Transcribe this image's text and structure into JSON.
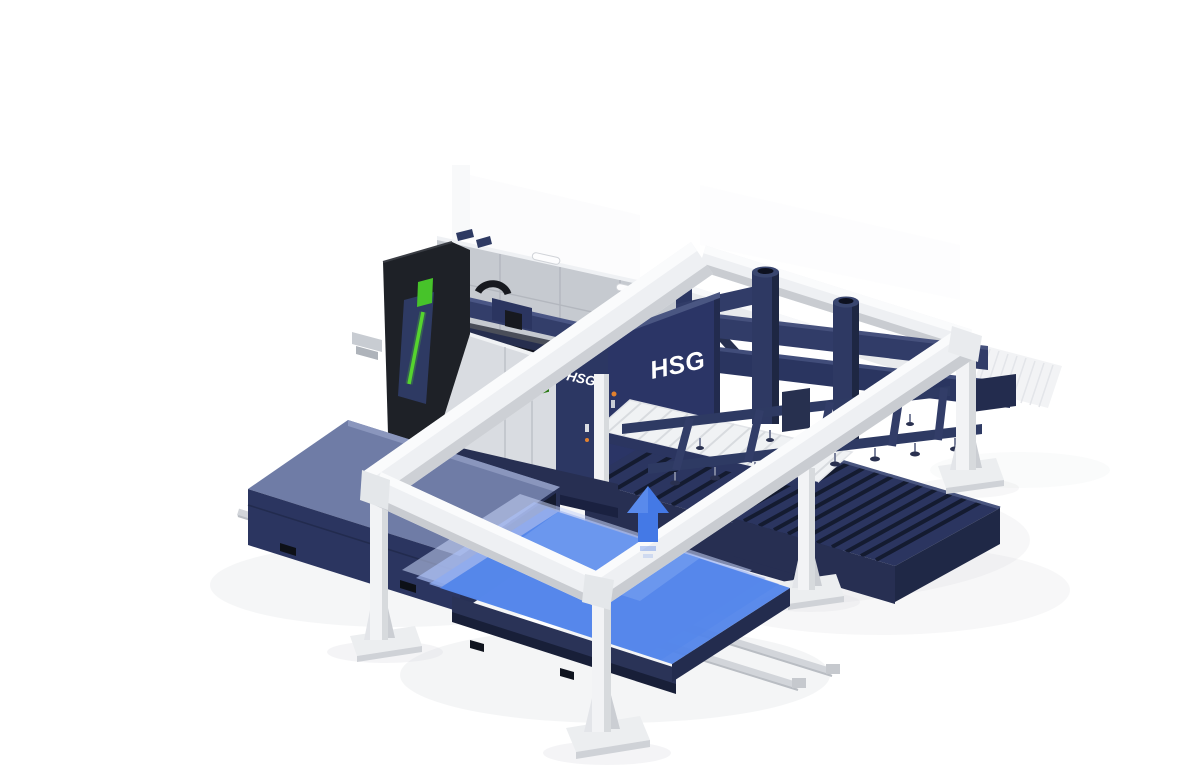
{
  "scene": {
    "description": "Isometric product render of an HSG fiber laser cutting machine with automatic sheet metal loading and unloading gantry system",
    "background_color": "#ffffff",
    "machine": {
      "brand_label": "HSG",
      "wall_color": "#d9dce1",
      "interior_wall_color": "#c6cad0",
      "left_end_color": "#1e2127",
      "accent_stripe_color": "#55d42e",
      "viewing_window_color": "#3aa51f",
      "base_color": "#272f52",
      "handle_slot_count": 3
    },
    "loader": {
      "brand_label": "HSG",
      "panel_color": "#2b3566",
      "column_count": 2,
      "suction_cup_count": 12,
      "indicator_color": "#e2812e"
    },
    "gantry_frame": {
      "beam_color": "#eef0f3",
      "leg_count": 5
    },
    "exchange_tables": {
      "count": 2,
      "frame_color": "#2b3560",
      "slat_color": "#141b30"
    },
    "material": {
      "cart_top_color": "#6f7ca6",
      "cart_body_color": "#2b3560",
      "sheet_count": 4,
      "sheet_top_color": "#5285ea"
    },
    "icons": {
      "up_arrow": {
        "name": "up-arrow-icon",
        "color": "#4479e6"
      }
    },
    "palette": {
      "logo_white": "#ffffff",
      "navy": "#2e3a63",
      "navy_dark": "#1f2848",
      "rail_gray": "#d2d5da"
    }
  }
}
